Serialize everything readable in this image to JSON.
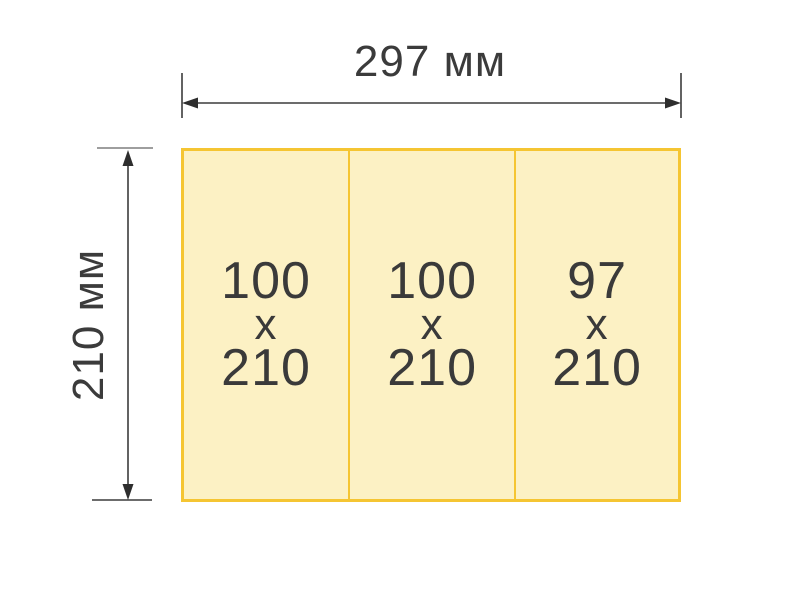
{
  "diagram": {
    "description_hint": "A4 landscape sheet split into three fold panels with dimension arrows",
    "dimensions": {
      "width_label": "297 мм",
      "height_label": "210 мм"
    },
    "sheet": {
      "panels": [
        {
          "top": "100",
          "sep": "x",
          "bottom": "210"
        },
        {
          "top": "100",
          "sep": "x",
          "bottom": "210"
        },
        {
          "top": "97",
          "sep": "x",
          "bottom": "210"
        }
      ]
    },
    "colors": {
      "sheet_fill": "#FCF1C4",
      "sheet_border": "#F5C532",
      "text": "#3A3A3A",
      "dimension_lines": "#3C3C3C",
      "top_extension_tick": "#9E9E9E",
      "background": "#FFFFFF"
    }
  }
}
